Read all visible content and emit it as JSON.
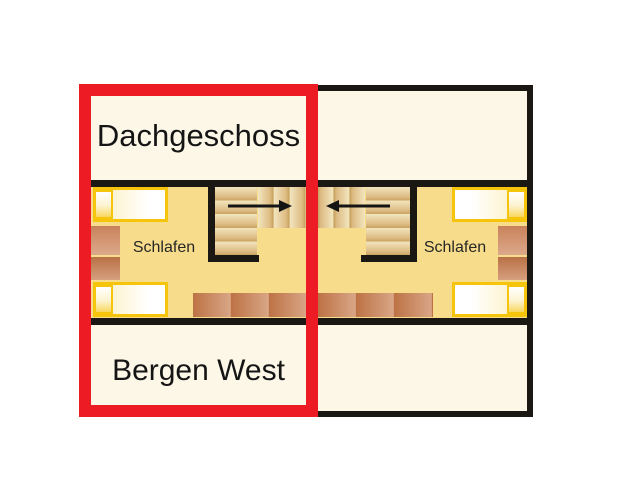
{
  "plan": {
    "upper_label": "Dachgeschoss",
    "lower_label": "Bergen West",
    "rooms": {
      "left_bedroom_label": "Schlafen",
      "right_bedroom_label": "Schlafen"
    },
    "arrows": {
      "left_unit_direction": "right",
      "right_unit_direction": "left"
    }
  },
  "colors": {
    "highlight_red": "#ED1C24",
    "floor_yellow": "#F7DD8B",
    "cream": "#FCF7E7",
    "bed_gold": "#F6C40B",
    "wall_black": "#1B1813",
    "wood_brown": "#C8825A",
    "tread_tan": "#DDBC84"
  }
}
